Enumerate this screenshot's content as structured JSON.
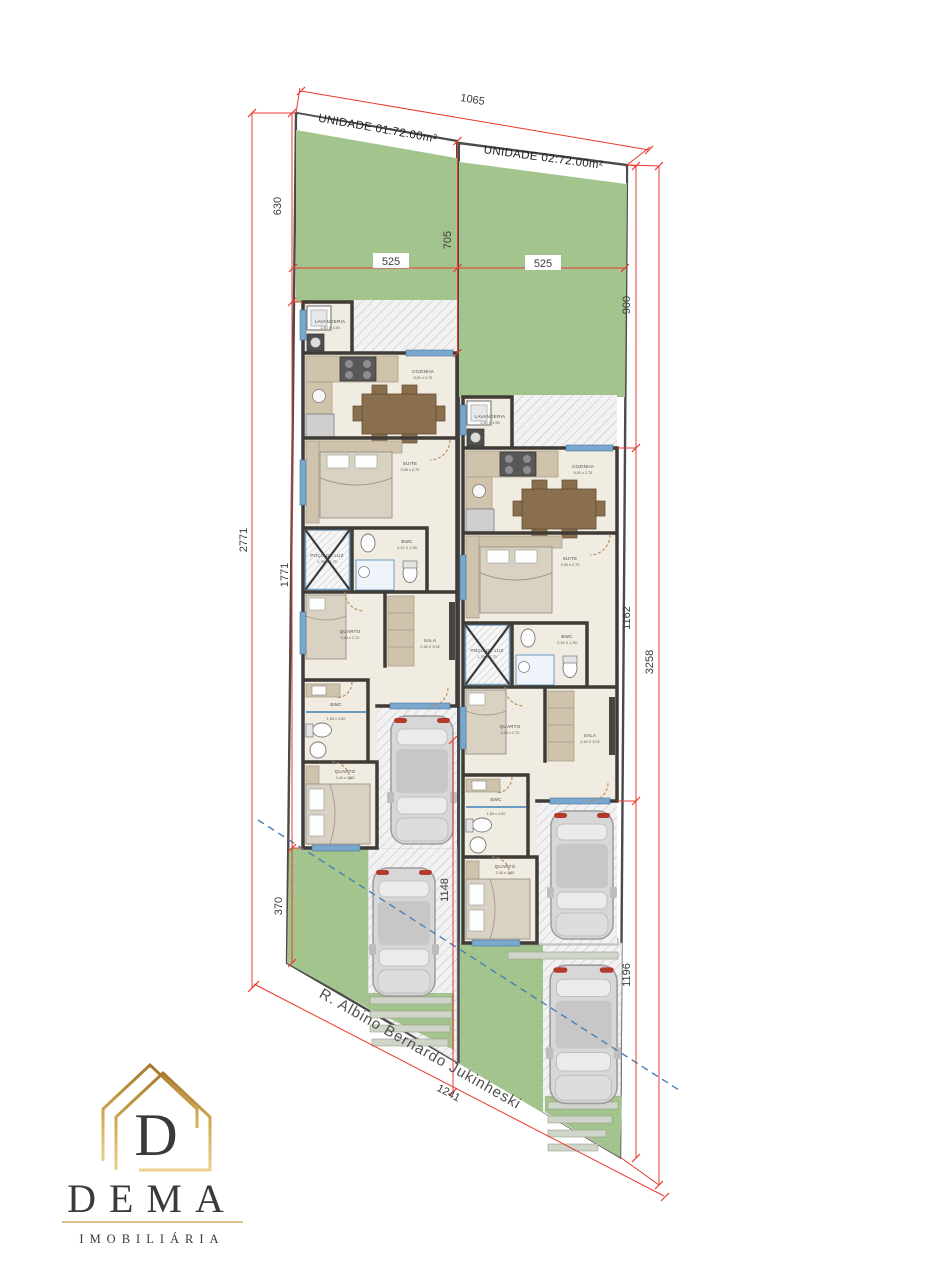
{
  "units": {
    "u1": "UNIDADE 01:72.00m²",
    "u2": "UNIDADE 02:72.00m²"
  },
  "street": {
    "name": "R. Albino Bernardo Jukinheski"
  },
  "dims": {
    "top": "1065",
    "left_total": "2771",
    "left_upper": "630",
    "left_mid": "1771",
    "left_lower": "370",
    "divider": "705",
    "lot1_width": "525",
    "lot2_width": "525",
    "right_upper": "900",
    "right_mid": "1162",
    "right_lower": "1196",
    "right_total": "3258",
    "street_front": "1241",
    "drive": "1148"
  },
  "rooms": {
    "lavanderia": {
      "n": "LAVANDERIA",
      "d": "1,50 X 1,50"
    },
    "cozinha": {
      "n": "COZINHA",
      "d": "5,01 x 2,75"
    },
    "suite": {
      "n": "SUITE",
      "d": "3,95 x 2,70"
    },
    "bwc_suite": {
      "n": "BWC",
      "d": "2,10 X 1,90"
    },
    "poco": {
      "n": "POÇO DE LUZ",
      "d": "1,75 X 1,75"
    },
    "quarto1": {
      "n": "QUARTO",
      "d": "2,40 x 2,70"
    },
    "sala": {
      "n": "SALA",
      "d": "2,49 X 3,92"
    },
    "bwc": {
      "n": "BWC",
      "d": "1,50 x 2,00"
    },
    "quarto2": {
      "n": "QUARTO",
      "d": "2,40 x 2,65"
    }
  },
  "logo": {
    "brand": "DEMA",
    "tagline": "IMOBILIÁRIA",
    "initial": "D"
  },
  "colors": {
    "green": "#a8c892",
    "red": "#e8392f",
    "gold": "#bb8c35",
    "blue_dash": "#4a7fb5"
  }
}
